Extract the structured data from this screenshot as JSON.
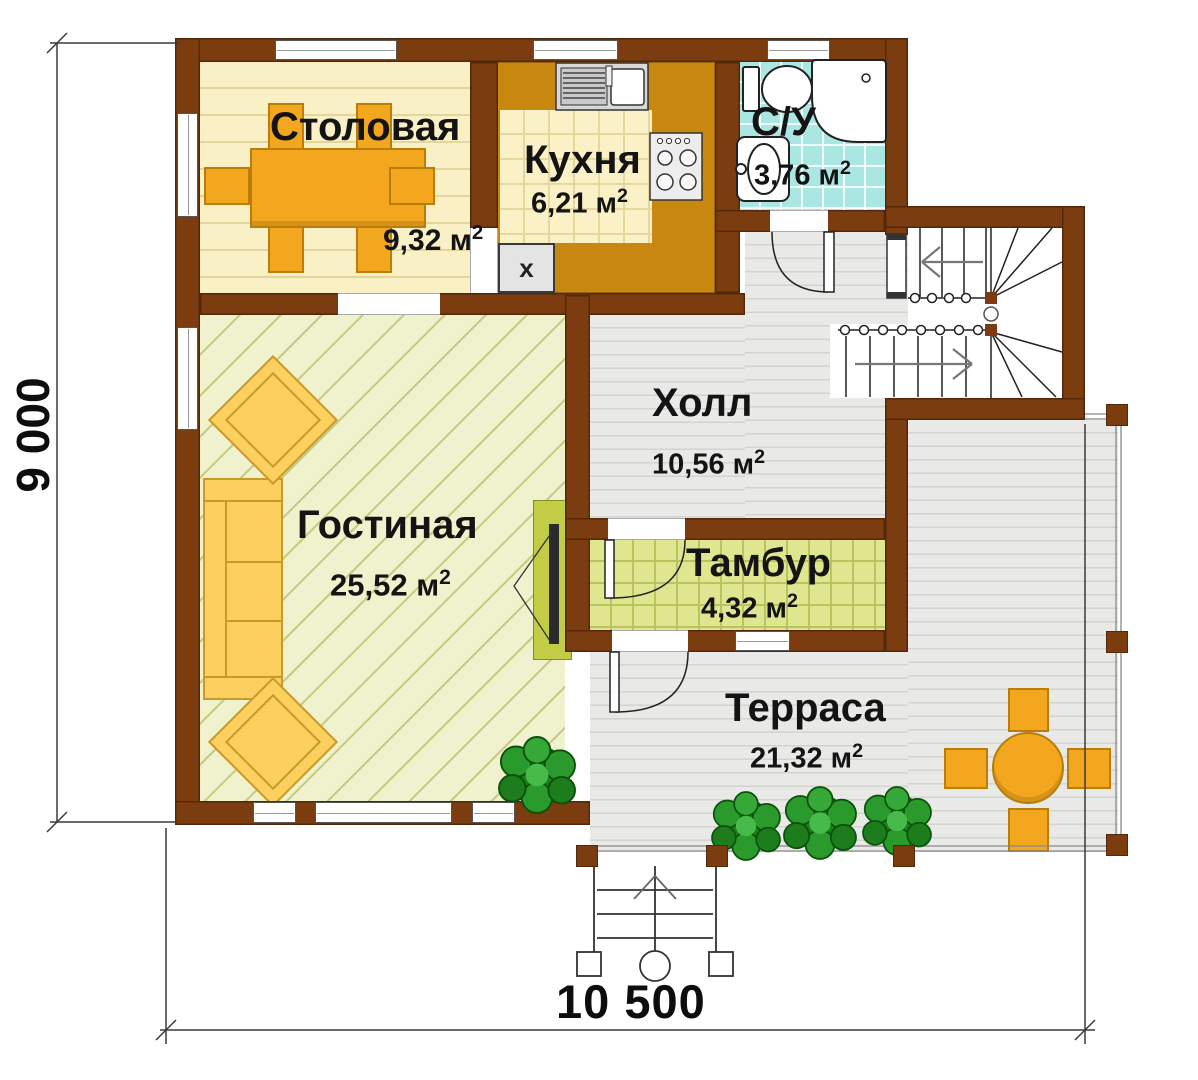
{
  "rooms": {
    "dining": {
      "label": "Столовая",
      "area": "9,32 м"
    },
    "kitchen": {
      "label": "Кухня",
      "area": "6,21 м"
    },
    "bathroom": {
      "label": "С/У",
      "area": "3,76 м"
    },
    "hall": {
      "label": "Холл",
      "area": "10,56 м"
    },
    "living": {
      "label": "Гостиная",
      "area": "25,52 м"
    },
    "vestibule": {
      "label": "Тамбур",
      "area": "4,32 м"
    },
    "terrace": {
      "label": "Терраса",
      "area": "21,32 м"
    }
  },
  "superscript": "2",
  "dimensions": {
    "height": "9 000",
    "width": "10 500"
  },
  "appliance_label": "x",
  "colors": {
    "wall": "#7b3d0f",
    "wall-b": "#53280a",
    "counter": "#c8880f",
    "floor-dining": "#faf0c5",
    "floor-bath": "#abe7e2",
    "floor-hall": "#e9e9e7",
    "floor-living": "#f0f1cd",
    "floor-tambour": "#dfe68f",
    "orange": "#f2a71f",
    "orange-b": "#b97d08",
    "sofa": "#fbd05e",
    "sofa-b": "#c9992a",
    "tv": "#c3cc45"
  }
}
